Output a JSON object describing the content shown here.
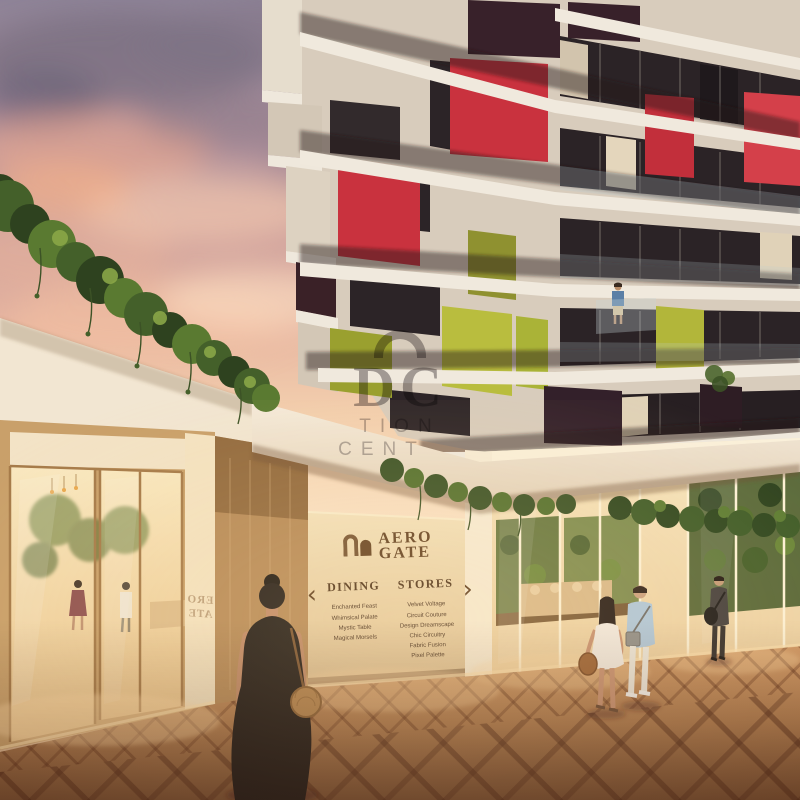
{
  "sign": {
    "brand": {
      "line1": "AERO",
      "line2": "GATE"
    },
    "chevron_left": "‹",
    "chevron_right": "›",
    "directory": {
      "dining": {
        "title": "DINING",
        "items": [
          "Enchanted Feast",
          "Whimsical Palate",
          "Mystic Table",
          "Magical Morsels"
        ]
      },
      "stores": {
        "title": "STORES",
        "items": [
          "Velvet Voltage",
          "Circuit Couture",
          "Design Dreamscape",
          "Chic Circuitry",
          "Fabric Fusion",
          "Pixel Palette"
        ]
      }
    }
  },
  "watermark": {
    "logo_text": "DC",
    "fragment_line1": "TION",
    "fragment_line2": "CENT"
  },
  "pillar_reflection": {
    "line1": "ERO",
    "line2": "ATE"
  },
  "colors": {
    "accent_red": "#c9323e",
    "accent_lime": "#b9bd3e",
    "accent_olive": "#9aa02f",
    "accent_maroon": "#38212a",
    "sign_wall": "#ecd8b2",
    "brand_brown": "#7b5936",
    "paving": "#b9824f",
    "sky_pink": "#e7b3a0",
    "sky_mauve": "#938798",
    "interior_glow": "#f6e0b2",
    "foliage": "#4c632c"
  }
}
